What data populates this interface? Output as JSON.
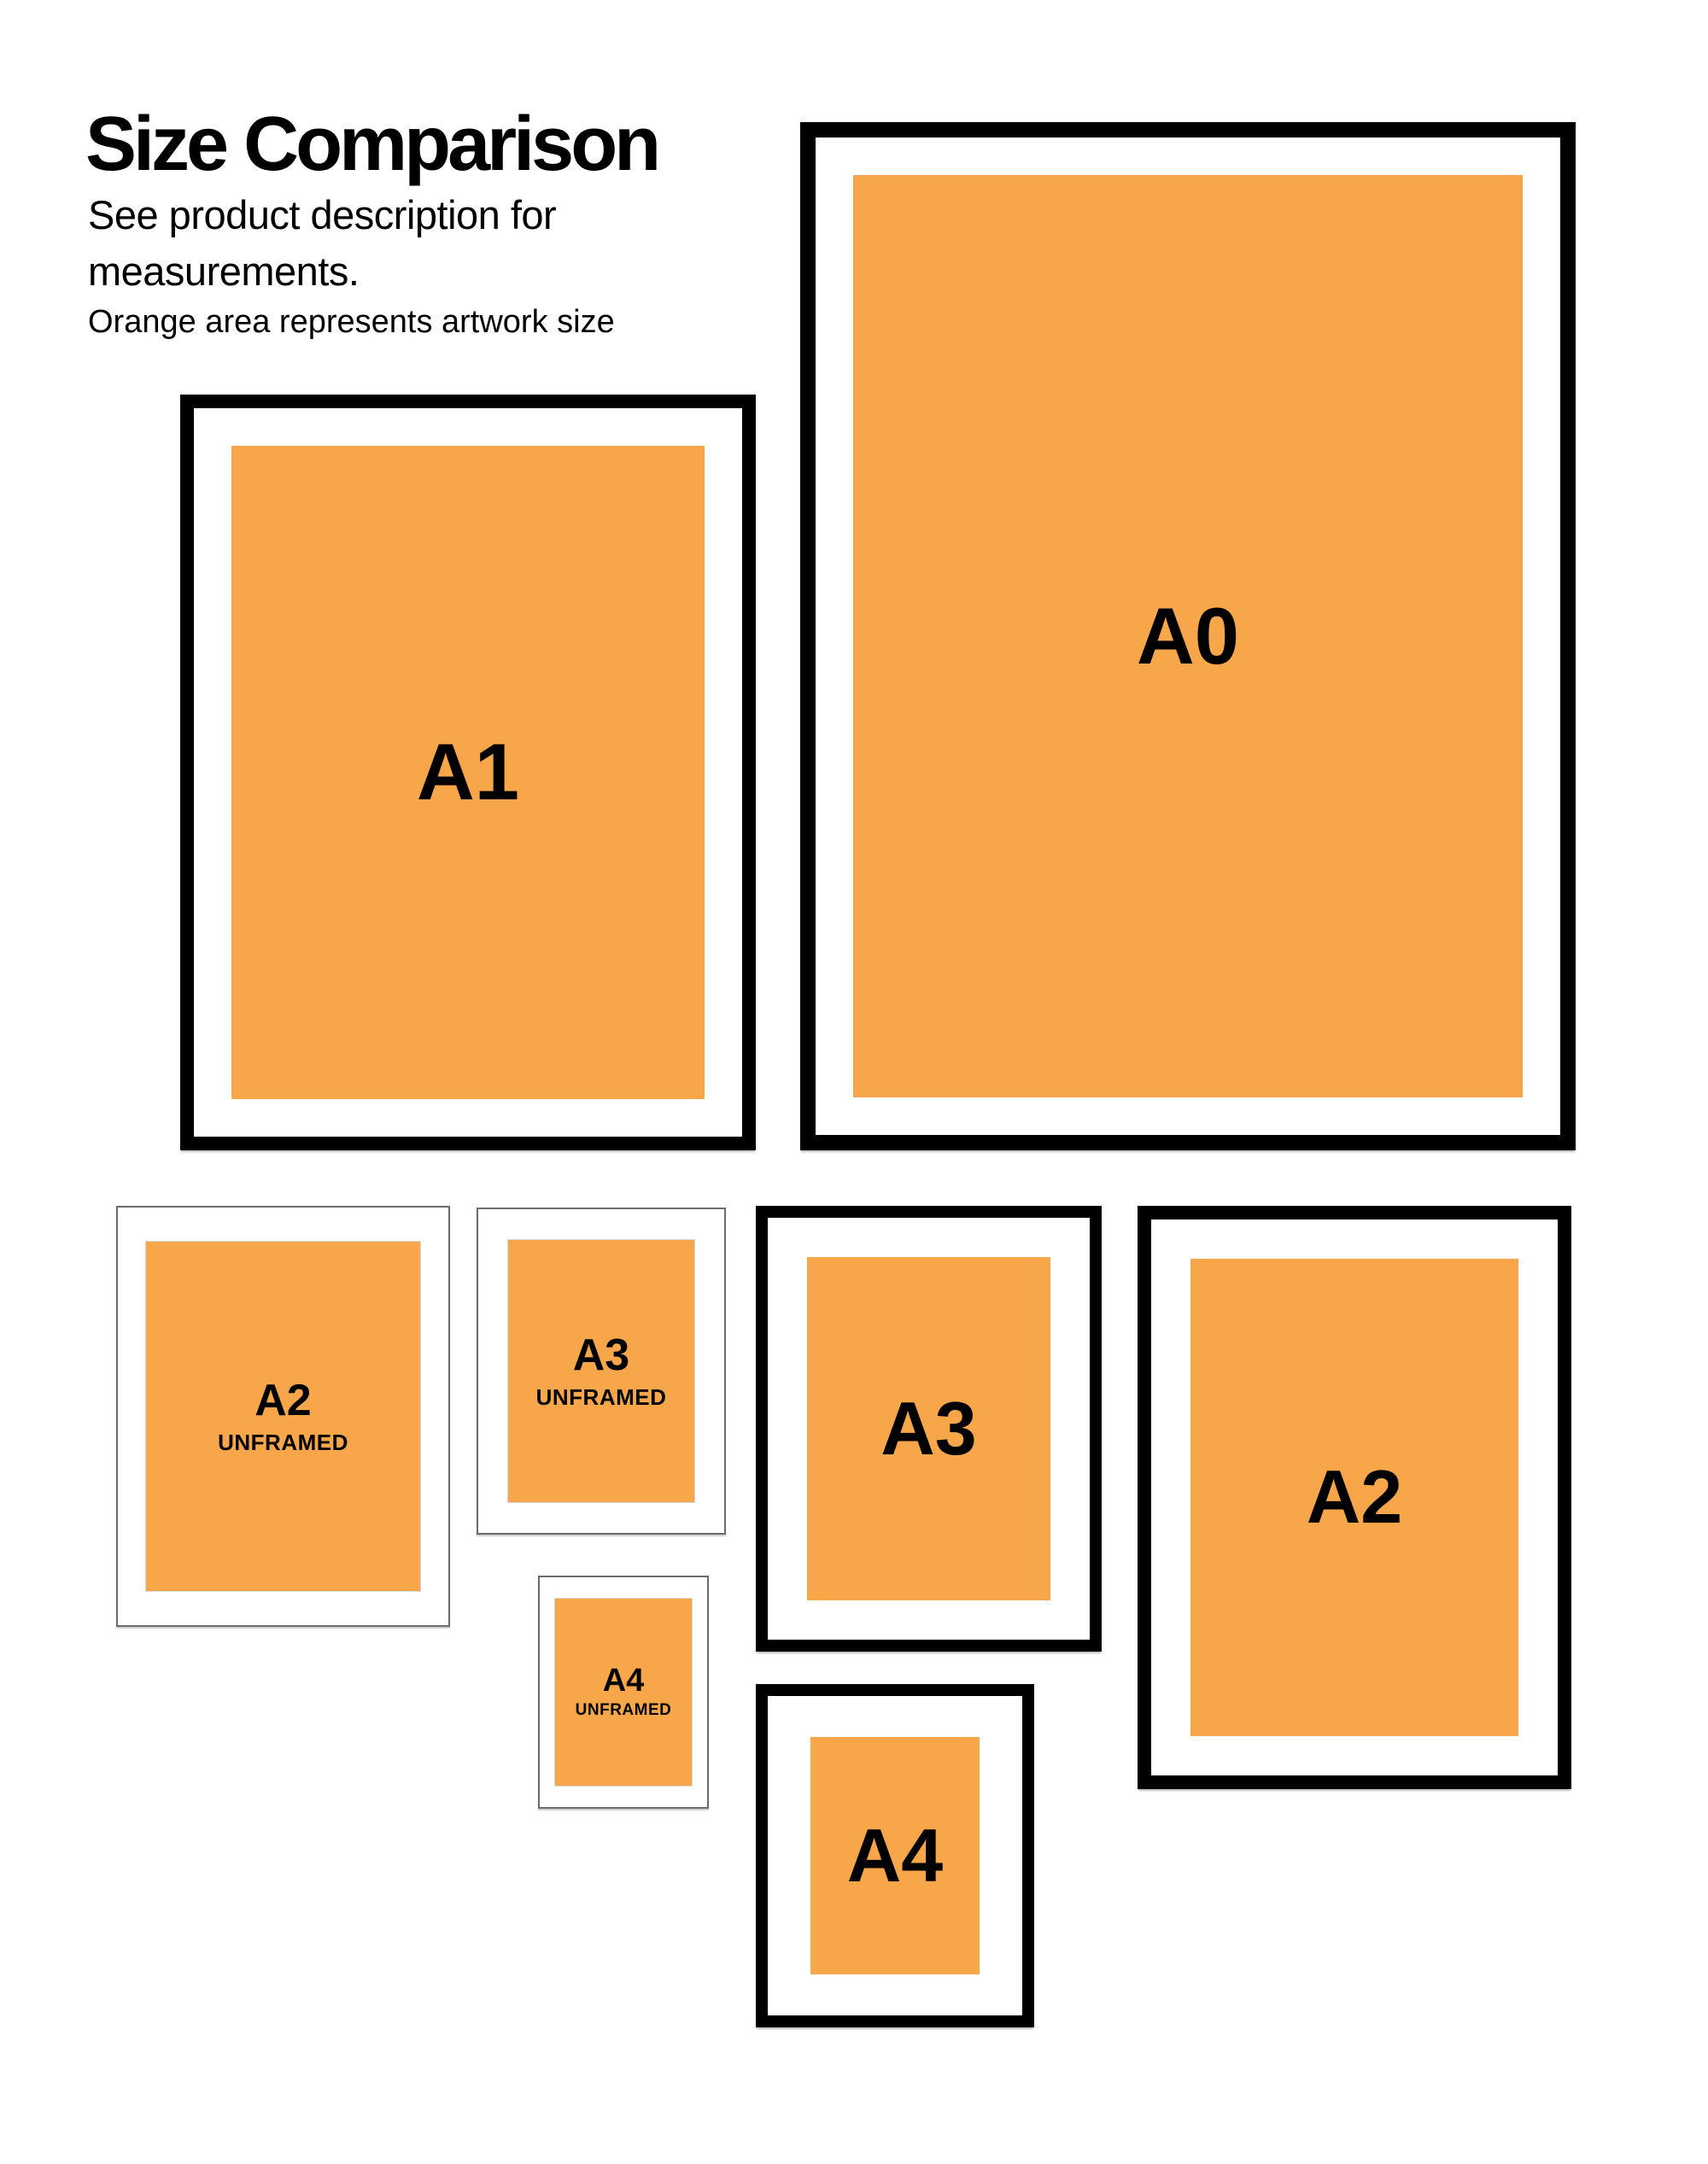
{
  "header": {
    "title": "Size Comparison",
    "subtitle_line1": "See product description for",
    "subtitle_line2": "measurements.",
    "caption": "Orange area represents artwork size"
  },
  "colors": {
    "artwork_orange": "#F8A64A",
    "frame_black": "#000000",
    "unframed_border_gray": "#6B6B6B",
    "mat_white": "#FFFFFF",
    "text_black": "#000000"
  },
  "items": [
    {
      "id": "a0-framed",
      "label": "A0",
      "sublabel": "",
      "type": "framed"
    },
    {
      "id": "a1-framed",
      "label": "A1",
      "sublabel": "",
      "type": "framed"
    },
    {
      "id": "a2-unframed",
      "label": "A2",
      "sublabel": "UNFRAMED",
      "type": "unframed"
    },
    {
      "id": "a3-unframed",
      "label": "A3",
      "sublabel": "UNFRAMED",
      "type": "unframed"
    },
    {
      "id": "a3-framed",
      "label": "A3",
      "sublabel": "",
      "type": "framed"
    },
    {
      "id": "a2-framed",
      "label": "A2",
      "sublabel": "",
      "type": "framed"
    },
    {
      "id": "a4-unframed",
      "label": "A4",
      "sublabel": "UNFRAMED",
      "type": "unframed"
    },
    {
      "id": "a4-framed",
      "label": "A4",
      "sublabel": "",
      "type": "framed"
    }
  ]
}
